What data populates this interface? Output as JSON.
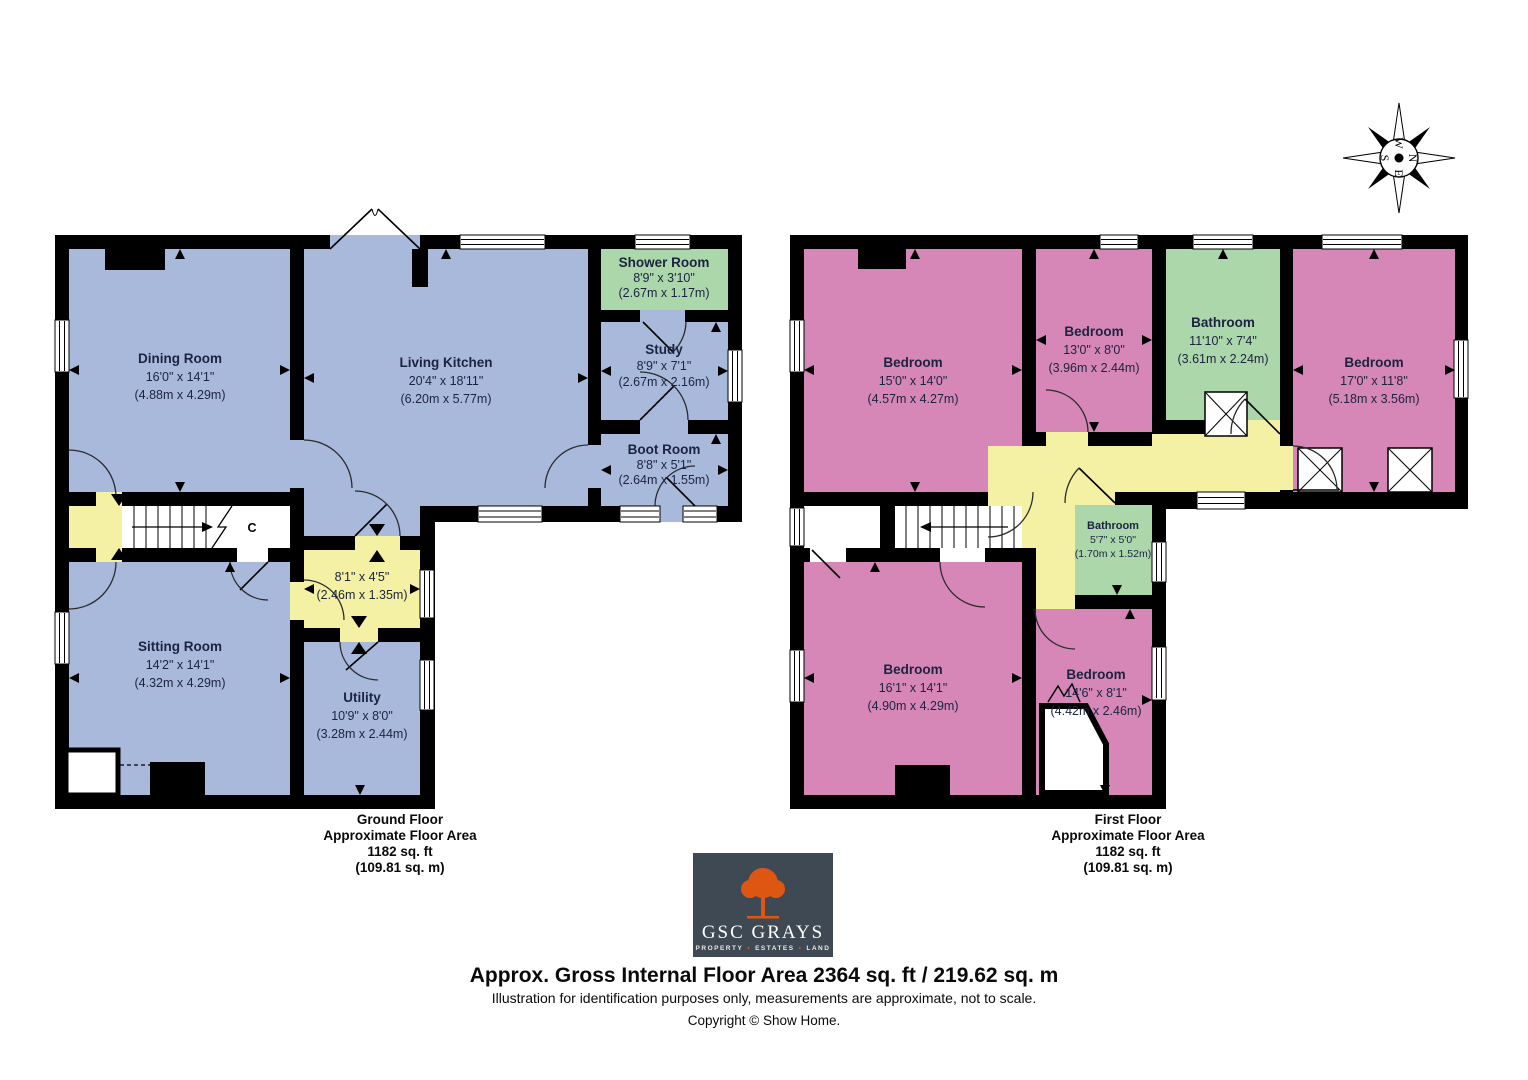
{
  "page": {
    "footer": {
      "headline": "Approx. Gross Internal Floor Area 2364 sq. ft / 219.62 sq. m",
      "disclaimer": "Illustration for identification purposes only, measurements are approximate, not to scale.",
      "copyright": "Copyright © Show Home."
    }
  },
  "colors": {
    "room_blue": "#a9b9dc",
    "room_pink": "#d687b7",
    "room_green": "#abd7ab",
    "hall_yellow": "#f5f1a4",
    "wall_black": "#000000",
    "label_ink": "#1c2340",
    "logo_bg": "#3e4953",
    "logo_orange": "#dd5713"
  },
  "compass": {
    "north": "N",
    "east": "E",
    "south": "S",
    "west": "W"
  },
  "logo": {
    "name": "GSC GRAYS",
    "word1": "PROPERTY",
    "word2": "ESTATES",
    "word3": "LAND",
    "separator": "•"
  },
  "ground_floor": {
    "caption": {
      "line1": "Ground Floor",
      "line2": "Approximate Floor Area",
      "line3": "1182 sq. ft",
      "line4": "(109.81 sq. m)"
    },
    "stair_label": "C",
    "rooms": {
      "dining": {
        "name": "Dining Room",
        "imperial": "16'0\" x 14'1\"",
        "metric": "(4.88m x 4.29m)"
      },
      "kitchen": {
        "name": "Living Kitchen",
        "imperial": "20'4\" x 18'11\"",
        "metric": "(6.20m x 5.77m)"
      },
      "shower": {
        "name": "Shower Room",
        "imperial": "8'9\" x 3'10\"",
        "metric": "(2.67m x 1.17m)"
      },
      "study": {
        "name": "Study",
        "imperial": "8'9\" x 7'1\"",
        "metric": "(2.67m x 2.16m)"
      },
      "boot": {
        "name": "Boot Room",
        "imperial": "8'8\" x 5'1\"",
        "metric": "(2.64m x 1.55m)"
      },
      "hall": {
        "imperial": "8'1\" x 4'5\"",
        "metric": "(2.46m x 1.35m)"
      },
      "sitting": {
        "name": "Sitting Room",
        "imperial": "14'2\" x 14'1\"",
        "metric": "(4.32m x 4.29m)"
      },
      "utility": {
        "name": "Utility",
        "imperial": "10'9\" x 8'0\"",
        "metric": "(3.28m x 2.44m)"
      }
    }
  },
  "first_floor": {
    "caption": {
      "line1": "First Floor",
      "line2": "Approximate Floor Area",
      "line3": "1182 sq. ft",
      "line4": "(109.81 sq. m)"
    },
    "rooms": {
      "bedroom1": {
        "name": "Bedroom",
        "imperial": "15'0\" x 14'0\"",
        "metric": "(4.57m x 4.27m)"
      },
      "bedroom2": {
        "name": "Bedroom",
        "imperial": "13'0\" x 8'0\"",
        "metric": "(3.96m x 2.44m)"
      },
      "bathroom1": {
        "name": "Bathroom",
        "imperial": "11'10\" x 7'4\"",
        "metric": "(3.61m x 2.24m)"
      },
      "bedroom3": {
        "name": "Bedroom",
        "imperial": "17'0\" x 11'8\"",
        "metric": "(5.18m x 3.56m)"
      },
      "bathroom2": {
        "name": "Bathroom",
        "imperial": "5'7\" x 5'0\"",
        "metric": "(1.70m x 1.52m)"
      },
      "bedroom4": {
        "name": "Bedroom",
        "imperial": "16'1\" x 14'1\"",
        "metric": "(4.90m x 4.29m)"
      },
      "bedroom5": {
        "name": "Bedroom",
        "imperial": "14'6\" x 8'1\"",
        "metric": "(4.42m x 2.46m)"
      }
    }
  }
}
